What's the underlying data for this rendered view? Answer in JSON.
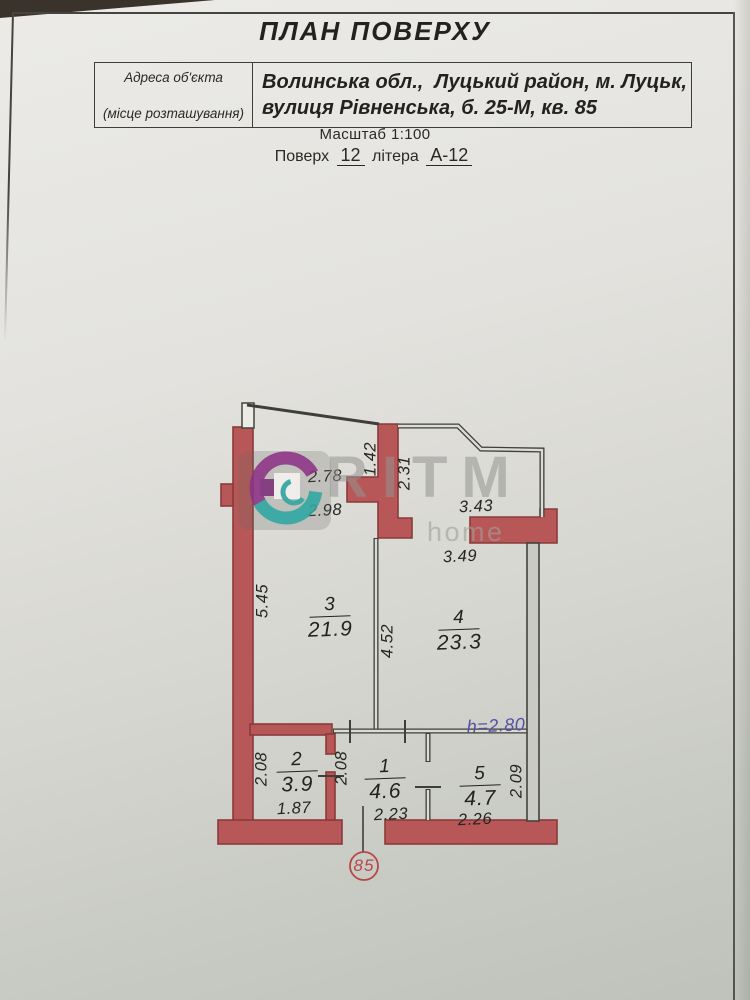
{
  "header": {
    "title": "ПЛАН ПОВЕРХУ",
    "address_label_1": "Адреса об'єкта",
    "address_label_2": "(місце розташування)",
    "address_line_1": "Волинська обл.,  Луцький район, м. Луцьк,",
    "address_line_2": "вулиця Рівненська, б. 25-М, кв. 85",
    "scale": "Масштаб 1:100",
    "floor_label": "Поверх",
    "floor_number": "12",
    "letter_label": "літера",
    "letter_value": "А-12"
  },
  "plan": {
    "rooms": [
      {
        "number": "1",
        "area": "4.6"
      },
      {
        "number": "2",
        "area": "3.9"
      },
      {
        "number": "3",
        "area": "21.9"
      },
      {
        "number": "4",
        "area": "23.3"
      },
      {
        "number": "5",
        "area": "4.7"
      }
    ],
    "dimensions": {
      "d278": "2.78",
      "d298": "2.98",
      "d142": "1.42",
      "d231": "2.31",
      "d343": "3.43",
      "d349": "3.49",
      "d545": "5.45",
      "d452": "4.52",
      "d208a": "2.08",
      "d208b": "2.08",
      "d209": "2.09",
      "d187": "1.87",
      "d223": "2.23",
      "d226": "2.26"
    },
    "ceiling_height": "h=2.80",
    "apartment_number": "85"
  },
  "watermark": {
    "brand": "RITM",
    "sub": "home"
  },
  "colors": {
    "wall_red": "#b85757",
    "wall_red_outline": "#8a3a3a",
    "height_note_blue": "#5252a6",
    "apartment_red": "#b94747"
  }
}
